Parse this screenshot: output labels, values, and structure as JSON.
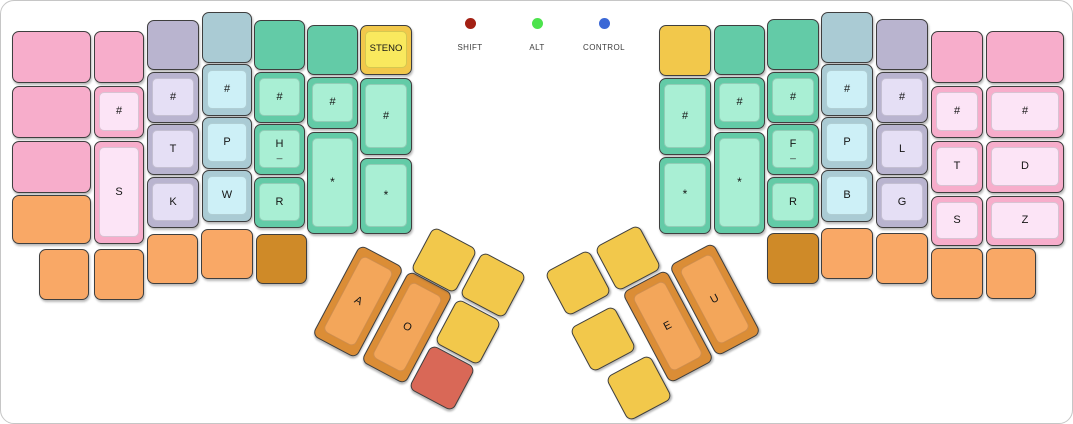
{
  "canvas": {
    "width": 1073,
    "height": 424,
    "background": "#ffffff",
    "border_color": "#c6c6c6"
  },
  "palette": {
    "pink": {
      "base": "#F7ADCB",
      "top": "#FCE4F6"
    },
    "lavender": {
      "base": "#B9B4CF",
      "top": "#E5DFF5"
    },
    "blue": {
      "base": "#AACBD4",
      "top": "#CDF0F7"
    },
    "green": {
      "base": "#63CBA7",
      "top": "#A9EFD4"
    },
    "yellow": {
      "base": "#F2C84B",
      "top": "#F9E95E"
    },
    "orange": {
      "base": "#F9A866",
      "top": "#F9A866"
    },
    "darkorange": {
      "base": "#CF8A28",
      "top": "#CF8A28"
    },
    "thumborange": {
      "base": "#DB8D36",
      "top": "#F3A65A"
    },
    "red": {
      "base": "#D96857",
      "top": "#D96857"
    }
  },
  "indicators": [
    {
      "label": "SHIFT",
      "color": "#A32014",
      "x": 469
    },
    {
      "label": "ALT",
      "color": "#4CE34C",
      "x": 536
    },
    {
      "label": "CONTROL",
      "color": "#3B68D6",
      "x": 603
    }
  ],
  "keys": [
    {
      "x": 11,
      "y": 30,
      "w": 79,
      "h": 52,
      "color": "pink",
      "style": "flat",
      "label": ""
    },
    {
      "x": 11,
      "y": 85,
      "w": 79,
      "h": 52,
      "color": "pink",
      "style": "flat",
      "label": ""
    },
    {
      "x": 11,
      "y": 140,
      "w": 79,
      "h": 52,
      "color": "pink",
      "style": "flat",
      "label": ""
    },
    {
      "x": 11,
      "y": 194,
      "w": 79,
      "h": 49,
      "color": "orange",
      "style": "flat",
      "label": ""
    },
    {
      "x": 93,
      "y": 30,
      "w": 50,
      "h": 52,
      "color": "pink",
      "style": "flat",
      "label": ""
    },
    {
      "x": 93,
      "y": 85,
      "w": 50,
      "h": 52,
      "color": "pink",
      "style": "cap",
      "label": "#"
    },
    {
      "x": 93,
      "y": 140,
      "w": 50,
      "h": 103,
      "color": "pink",
      "style": "cap",
      "label": "S"
    },
    {
      "x": 146,
      "y": 19,
      "w": 52,
      "h": 50,
      "color": "lavender",
      "style": "flat",
      "label": ""
    },
    {
      "x": 146,
      "y": 71,
      "w": 52,
      "h": 51,
      "color": "lavender",
      "style": "cap",
      "label": "#"
    },
    {
      "x": 146,
      "y": 123,
      "w": 52,
      "h": 51,
      "color": "lavender",
      "style": "cap",
      "label": "T"
    },
    {
      "x": 146,
      "y": 176,
      "w": 52,
      "h": 51,
      "color": "lavender",
      "style": "cap",
      "label": "K"
    },
    {
      "x": 201,
      "y": 11,
      "w": 50,
      "h": 51,
      "color": "blue",
      "style": "flat",
      "label": ""
    },
    {
      "x": 201,
      "y": 63,
      "w": 50,
      "h": 52,
      "color": "blue",
      "style": "cap",
      "label": "#"
    },
    {
      "x": 201,
      "y": 116,
      "w": 50,
      "h": 52,
      "color": "blue",
      "style": "cap",
      "label": "P"
    },
    {
      "x": 201,
      "y": 169,
      "w": 50,
      "h": 52,
      "color": "blue",
      "style": "cap",
      "label": "W"
    },
    {
      "x": 253,
      "y": 19,
      "w": 51,
      "h": 50,
      "color": "green",
      "style": "flat",
      "label": ""
    },
    {
      "x": 253,
      "y": 71,
      "w": 51,
      "h": 51,
      "color": "green",
      "style": "cap",
      "label": "#"
    },
    {
      "x": 253,
      "y": 123,
      "w": 51,
      "h": 51,
      "color": "green",
      "style": "cap",
      "label": "H",
      "sub": "_"
    },
    {
      "x": 253,
      "y": 176,
      "w": 51,
      "h": 51,
      "color": "green",
      "style": "cap",
      "label": "R"
    },
    {
      "x": 306,
      "y": 24,
      "w": 51,
      "h": 50,
      "color": "green",
      "style": "flat",
      "label": ""
    },
    {
      "x": 306,
      "y": 76,
      "w": 51,
      "h": 52,
      "color": "green",
      "style": "cap",
      "label": "#"
    },
    {
      "x": 306,
      "y": 131,
      "w": 51,
      "h": 102,
      "color": "green",
      "style": "cap",
      "label": "*"
    },
    {
      "x": 359,
      "y": 24,
      "w": 52,
      "h": 50,
      "color": "yellow",
      "style": "cap",
      "label": "STENO"
    },
    {
      "x": 359,
      "y": 77,
      "w": 52,
      "h": 77,
      "color": "green",
      "style": "cap",
      "label": "#"
    },
    {
      "x": 359,
      "y": 157,
      "w": 52,
      "h": 76,
      "color": "green",
      "style": "cap",
      "label": "*"
    },
    {
      "x": 38,
      "y": 248,
      "w": 50,
      "h": 51,
      "color": "orange",
      "style": "flat",
      "label": ""
    },
    {
      "x": 93,
      "y": 248,
      "w": 50,
      "h": 51,
      "color": "orange",
      "style": "flat",
      "label": ""
    },
    {
      "x": 146,
      "y": 233,
      "w": 51,
      "h": 50,
      "color": "orange",
      "style": "flat",
      "label": ""
    },
    {
      "x": 200,
      "y": 228,
      "w": 52,
      "h": 50,
      "color": "orange",
      "style": "flat",
      "label": ""
    },
    {
      "x": 255,
      "y": 233,
      "w": 51,
      "h": 50,
      "color": "darkorange",
      "style": "flat",
      "label": ""
    },
    {
      "x": 332,
      "y": 249,
      "w": 50,
      "h": 103,
      "color": "thumborange",
      "style": "cap",
      "label": "A",
      "rot": 28
    },
    {
      "x": 381,
      "y": 275,
      "w": 50,
      "h": 103,
      "color": "thumborange",
      "style": "cap",
      "label": "O",
      "rot": 28
    },
    {
      "x": 418,
      "y": 234,
      "w": 50,
      "h": 50,
      "color": "yellow",
      "style": "flat",
      "label": "",
      "rot": 28
    },
    {
      "x": 467,
      "y": 259,
      "w": 50,
      "h": 50,
      "color": "yellow",
      "style": "flat",
      "label": "",
      "rot": 28
    },
    {
      "x": 442,
      "y": 306,
      "w": 50,
      "h": 50,
      "color": "yellow",
      "style": "flat",
      "label": "",
      "rot": 28
    },
    {
      "x": 416,
      "y": 352,
      "w": 50,
      "h": 50,
      "color": "red",
      "style": "flat",
      "label": "",
      "rot": 28
    },
    {
      "x": 602,
      "y": 232,
      "w": 50,
      "h": 50,
      "color": "yellow",
      "style": "flat",
      "label": "",
      "rot": -28
    },
    {
      "x": 552,
      "y": 257,
      "w": 50,
      "h": 50,
      "color": "yellow",
      "style": "flat",
      "label": "",
      "rot": -28
    },
    {
      "x": 577,
      "y": 313,
      "w": 50,
      "h": 50,
      "color": "yellow",
      "style": "flat",
      "label": "",
      "rot": -28
    },
    {
      "x": 613,
      "y": 362,
      "w": 50,
      "h": 50,
      "color": "yellow",
      "style": "flat",
      "label": "",
      "rot": -28
    },
    {
      "x": 642,
      "y": 274,
      "w": 50,
      "h": 103,
      "color": "thumborange",
      "style": "cap",
      "label": "E",
      "rot": -28
    },
    {
      "x": 689,
      "y": 247,
      "w": 50,
      "h": 103,
      "color": "thumborange",
      "style": "cap",
      "label": "U",
      "rot": -28
    },
    {
      "x": 658,
      "y": 24,
      "w": 52,
      "h": 51,
      "color": "yellow",
      "style": "flat",
      "label": ""
    },
    {
      "x": 658,
      "y": 77,
      "w": 52,
      "h": 77,
      "color": "green",
      "style": "cap",
      "label": "#"
    },
    {
      "x": 658,
      "y": 156,
      "w": 52,
      "h": 77,
      "color": "green",
      "style": "cap",
      "label": "*"
    },
    {
      "x": 713,
      "y": 24,
      "w": 51,
      "h": 50,
      "color": "green",
      "style": "flat",
      "label": ""
    },
    {
      "x": 713,
      "y": 76,
      "w": 51,
      "h": 52,
      "color": "green",
      "style": "cap",
      "label": "#"
    },
    {
      "x": 713,
      "y": 131,
      "w": 51,
      "h": 102,
      "color": "green",
      "style": "cap",
      "label": "*"
    },
    {
      "x": 766,
      "y": 18,
      "w": 52,
      "h": 51,
      "color": "green",
      "style": "flat",
      "label": ""
    },
    {
      "x": 766,
      "y": 71,
      "w": 52,
      "h": 51,
      "color": "green",
      "style": "cap",
      "label": "#"
    },
    {
      "x": 766,
      "y": 123,
      "w": 52,
      "h": 51,
      "color": "green",
      "style": "cap",
      "label": "F",
      "sub": "_"
    },
    {
      "x": 766,
      "y": 176,
      "w": 52,
      "h": 51,
      "color": "green",
      "style": "cap",
      "label": "R"
    },
    {
      "x": 820,
      "y": 11,
      "w": 52,
      "h": 51,
      "color": "blue",
      "style": "flat",
      "label": ""
    },
    {
      "x": 820,
      "y": 63,
      "w": 52,
      "h": 52,
      "color": "blue",
      "style": "cap",
      "label": "#"
    },
    {
      "x": 820,
      "y": 116,
      "w": 52,
      "h": 52,
      "color": "blue",
      "style": "cap",
      "label": "P"
    },
    {
      "x": 820,
      "y": 169,
      "w": 52,
      "h": 52,
      "color": "blue",
      "style": "cap",
      "label": "B"
    },
    {
      "x": 875,
      "y": 18,
      "w": 52,
      "h": 51,
      "color": "lavender",
      "style": "flat",
      "label": ""
    },
    {
      "x": 875,
      "y": 71,
      "w": 52,
      "h": 51,
      "color": "lavender",
      "style": "cap",
      "label": "#"
    },
    {
      "x": 875,
      "y": 123,
      "w": 52,
      "h": 51,
      "color": "lavender",
      "style": "cap",
      "label": "L"
    },
    {
      "x": 875,
      "y": 176,
      "w": 52,
      "h": 51,
      "color": "lavender",
      "style": "cap",
      "label": "G"
    },
    {
      "x": 930,
      "y": 30,
      "w": 52,
      "h": 52,
      "color": "pink",
      "style": "flat",
      "label": ""
    },
    {
      "x": 930,
      "y": 85,
      "w": 52,
      "h": 52,
      "color": "pink",
      "style": "cap",
      "label": "#"
    },
    {
      "x": 930,
      "y": 140,
      "w": 52,
      "h": 52,
      "color": "pink",
      "style": "cap",
      "label": "T"
    },
    {
      "x": 930,
      "y": 195,
      "w": 52,
      "h": 50,
      "color": "pink",
      "style": "cap",
      "label": "S"
    },
    {
      "x": 985,
      "y": 30,
      "w": 78,
      "h": 52,
      "color": "pink",
      "style": "flat",
      "label": ""
    },
    {
      "x": 985,
      "y": 85,
      "w": 78,
      "h": 52,
      "color": "pink",
      "style": "cap",
      "label": "#"
    },
    {
      "x": 985,
      "y": 140,
      "w": 78,
      "h": 52,
      "color": "pink",
      "style": "cap",
      "label": "D"
    },
    {
      "x": 985,
      "y": 195,
      "w": 78,
      "h": 50,
      "color": "pink",
      "style": "cap",
      "label": "Z"
    },
    {
      "x": 766,
      "y": 232,
      "w": 52,
      "h": 51,
      "color": "darkorange",
      "style": "flat",
      "label": ""
    },
    {
      "x": 820,
      "y": 227,
      "w": 52,
      "h": 51,
      "color": "orange",
      "style": "flat",
      "label": ""
    },
    {
      "x": 875,
      "y": 232,
      "w": 52,
      "h": 51,
      "color": "orange",
      "style": "flat",
      "label": ""
    },
    {
      "x": 930,
      "y": 247,
      "w": 52,
      "h": 51,
      "color": "orange",
      "style": "flat",
      "label": ""
    },
    {
      "x": 985,
      "y": 247,
      "w": 50,
      "h": 51,
      "color": "orange",
      "style": "flat",
      "label": ""
    }
  ]
}
